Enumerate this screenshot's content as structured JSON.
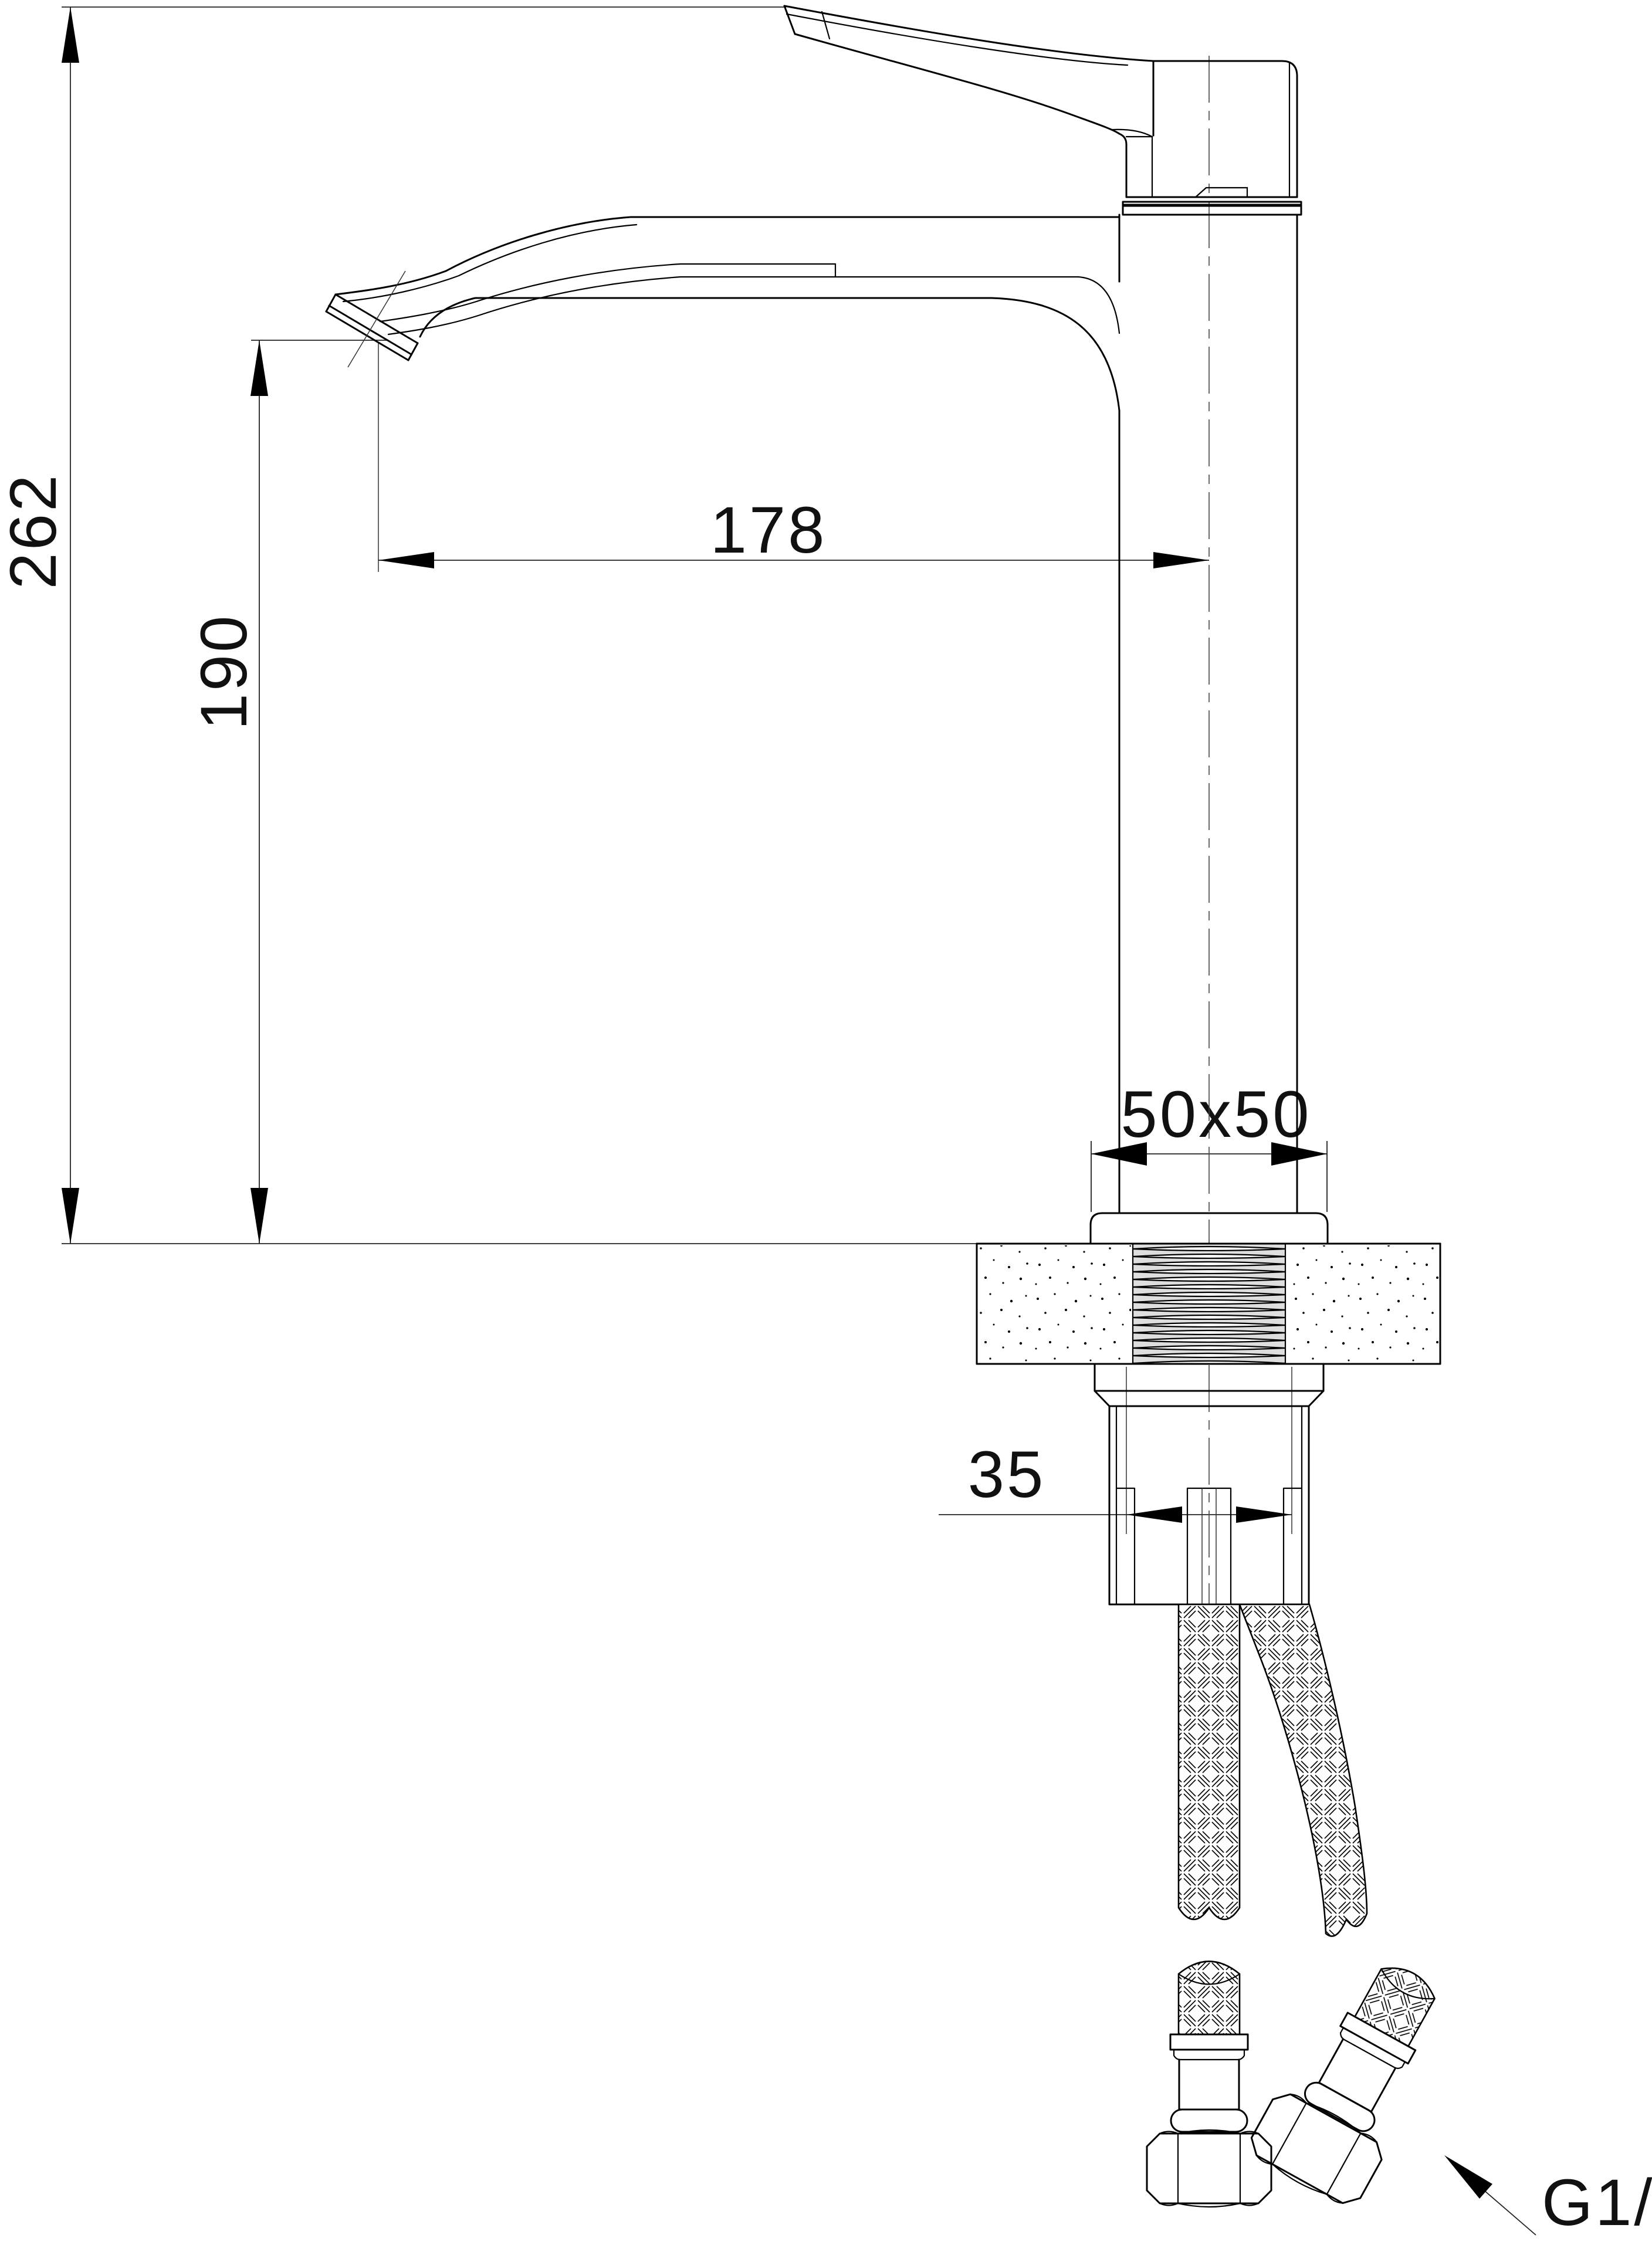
{
  "drawing": {
    "type": "technical-dimension-drawing",
    "subject": "tall single-lever basin mixer faucet, side elevation with mounting cross-section",
    "background_color": "#ffffff",
    "line_color": "#000000"
  },
  "labels": {
    "total_height": "262",
    "spout_outlet_height": "190",
    "spout_reach": "178",
    "base_footprint": "50x50",
    "shank_width": "35",
    "connection_thread": "G1/2"
  }
}
